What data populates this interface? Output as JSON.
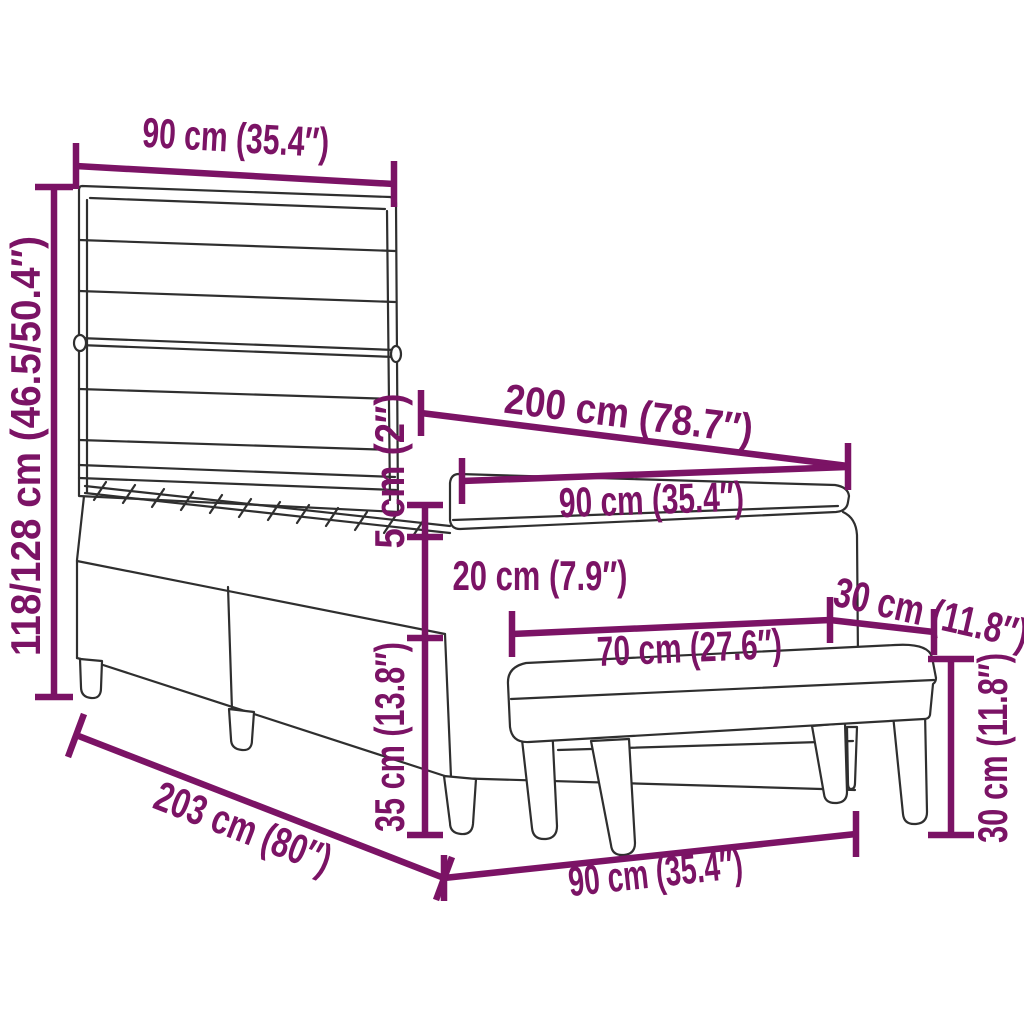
{
  "diagram": {
    "background": "#ffffff",
    "accent_color": "#7b1365",
    "line_color": "#2f2f2f",
    "labels": {
      "headboard_width": "90 cm (35.4″)",
      "overall_height": "118/128 cm (46.5/50.4″)",
      "bed_length": "200 cm (78.7″)",
      "mattress_width": "90 cm (35.4″)",
      "mattress_thickness": "5 cm (2″)",
      "base_height": "20 cm (7.9″)",
      "base_with_legs_height": "35 cm (13.8″)",
      "bench_depth": "30 cm (11.8″)",
      "bench_length": "70 cm (27.6″)",
      "bench_height": "30 cm (11.8″)",
      "frame_length": "203 cm (80″)",
      "bench_width": "90 cm (35.4″)"
    }
  }
}
